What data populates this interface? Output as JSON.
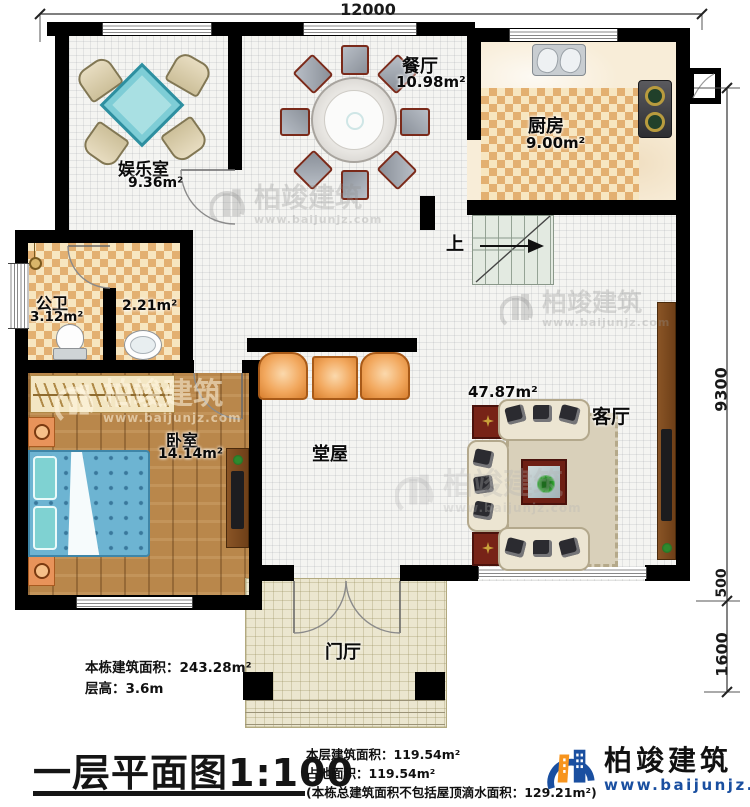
{
  "plan": {
    "title": "一层平面图1:100",
    "dimensions": {
      "top": "12000",
      "right_total": "9300",
      "right_step": "500",
      "right_porch": "1600"
    },
    "rooms": {
      "dining": {
        "name": "餐厅",
        "area": "10.98m²"
      },
      "kitchen": {
        "name": "厨房",
        "area": "9.00m²"
      },
      "entertainment": {
        "name": "娱乐室",
        "area": "9.36m²"
      },
      "bathroom": {
        "name": "公卫",
        "area": "3.12m²"
      },
      "washroom": {
        "area": "2.21m²"
      },
      "bedroom": {
        "name": "卧室",
        "area": "14.14m²"
      },
      "hall": {
        "name": "堂屋"
      },
      "living": {
        "name": "客厅",
        "area": "47.87m²"
      },
      "foyer": {
        "name": "门厅"
      },
      "stairs": {
        "direction": "上"
      }
    },
    "notes_left": {
      "line1": "本栋建筑面积：243.28m²",
      "line2": "层高：3.6m"
    },
    "notes_center": {
      "line1": "本层建筑面积：119.54m²",
      "line2": "占地面积：119.54m²",
      "line3": "(本栋总建筑面积不包括屋顶滴水面积：129.21m²)"
    },
    "brand": {
      "name": "柏竣建筑",
      "website": "www.baijunjz.com",
      "blue": "#1a4fa0",
      "orange": "#f7941d"
    },
    "watermark": {
      "name": "柏竣建筑",
      "website": "www.baijunjz.com"
    }
  }
}
